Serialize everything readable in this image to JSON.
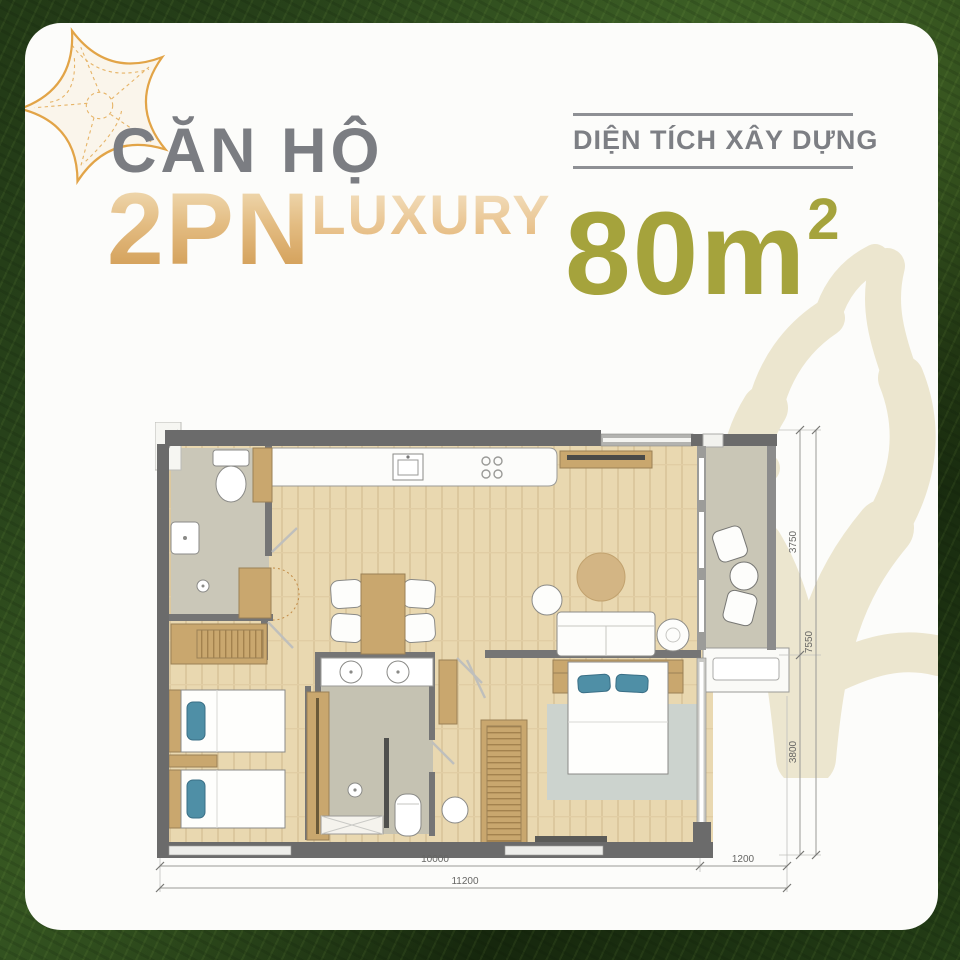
{
  "header": {
    "title": "CĂN HỘ",
    "unit": "2PN",
    "tier": "LUXURY",
    "area_label": "DIỆN TÍCH XÂY DỰNG",
    "area_value": "80m",
    "area_sup": "2"
  },
  "colors": {
    "background_green": "#233c17",
    "gold_accent": "#d9a55e",
    "olive_accent": "#a5a33c",
    "gray_text": "#7b7d82",
    "coral_watermark": "#ece6cf",
    "wall_gray": "#6b6b6b",
    "wood_floor": "#e9d8b0",
    "tile_floor": "#c9c6b8",
    "furniture_wood": "#c9a76e",
    "pillow_blue": "#4f8fa6"
  },
  "plan": {
    "dims": {
      "right_top": "3750",
      "right_total": "7550",
      "right_bottom": "3800",
      "bottom_main": "10000",
      "bottom_side": "1200",
      "bottom_total": "11200"
    }
  }
}
